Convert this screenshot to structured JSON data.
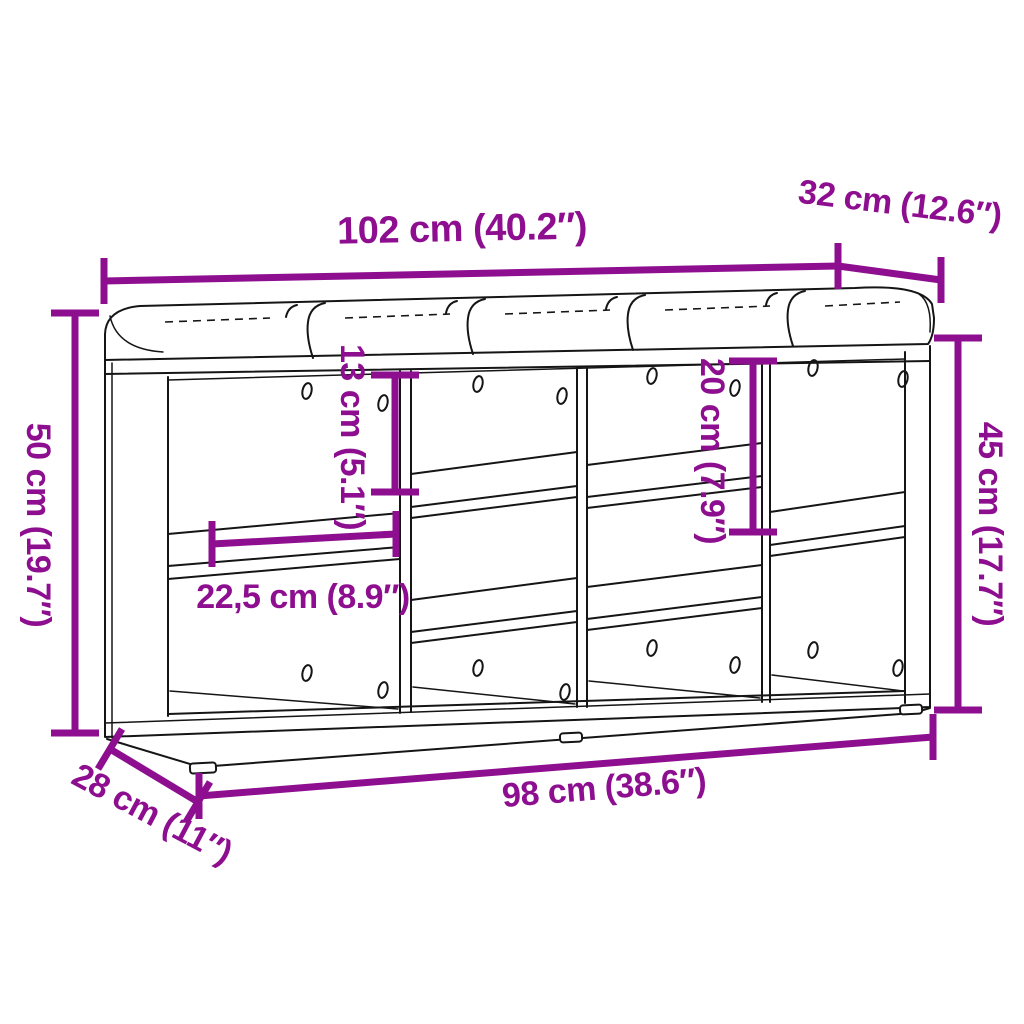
{
  "diagram_type": "furniture-dimension-diagram",
  "labels": {
    "top_width": "102 cm (40.2″)",
    "top_depth": "32 cm (12.6″)",
    "left_height": "50 cm (19.7″)",
    "shelf_gap_13": "13 cm (5.1″)",
    "shelf_gap_20": "20 cm (7.9″)",
    "right_height": "45 cm (17.7″)",
    "compartment_width": "22,5 cm (8.9″)",
    "bottom_width": "98 cm (38.6″)",
    "bottom_depth": "28 cm (11″)"
  },
  "colors": {
    "dimension_accent": "#8E0E90",
    "outline": "#151515",
    "background": "#FFFFFF"
  }
}
